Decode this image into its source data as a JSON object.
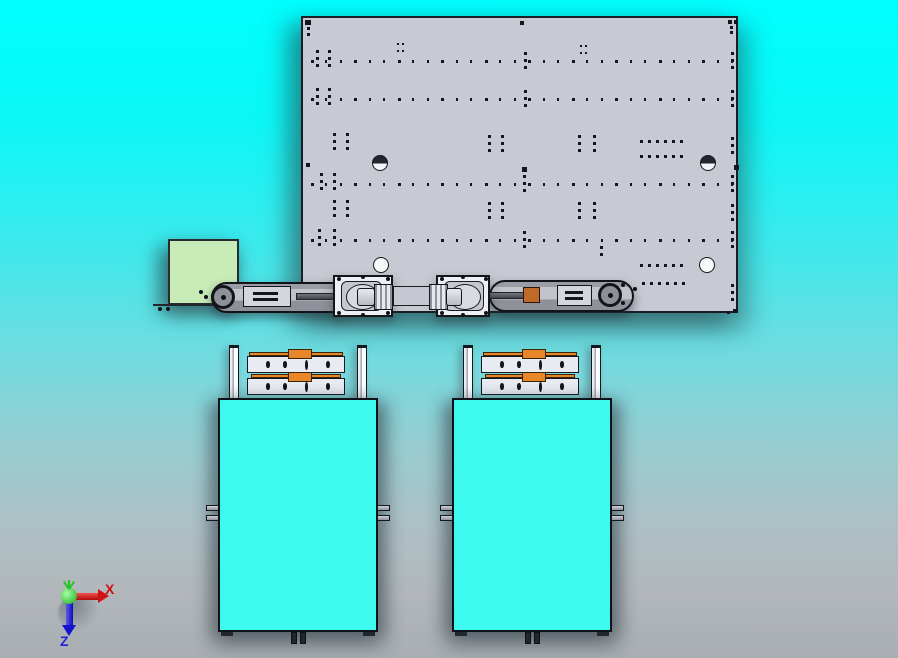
{
  "viewport": {
    "width": 898,
    "height": 658,
    "background_top": "#00ffff",
    "background_bottom": "#a9aeb2"
  },
  "triad": {
    "origin": {
      "x": 70,
      "y": 597
    },
    "x_label": "X",
    "z_label": "Z",
    "x_color": "#cc0f0f",
    "z_color": "#2222d8",
    "y_color": "#27c427"
  },
  "colors": {
    "plate_fill": "#c8c9d2",
    "plate_line": "#1a1d24",
    "green_box": "#c8ecb8",
    "cart_cyan": "#3efaee",
    "orange": "#e8872a",
    "part_white": "#edeff5",
    "arm_gray": "#b0b2ba",
    "rod_dark": "#4e5058"
  },
  "plate": {
    "x": 301,
    "y": 16,
    "w": 437,
    "h": 297,
    "tick_rows": [
      {
        "y": 42,
        "x0": 8,
        "x1": 428,
        "n": 30
      },
      {
        "y": 80,
        "x0": 8,
        "x1": 428,
        "n": 30
      },
      {
        "y": 165,
        "x0": 8,
        "x1": 428,
        "n": 30
      },
      {
        "y": 221,
        "x0": 8,
        "x1": 428,
        "n": 30
      }
    ],
    "pair_columns": [
      {
        "x": 13,
        "y": 32
      },
      {
        "x": 25,
        "y": 32
      },
      {
        "x": 221,
        "y": 34
      },
      {
        "x": 428,
        "y": 34
      },
      {
        "x": 13,
        "y": 70
      },
      {
        "x": 25,
        "y": 70
      },
      {
        "x": 221,
        "y": 72
      },
      {
        "x": 428,
        "y": 72
      },
      {
        "x": 17,
        "y": 155
      },
      {
        "x": 30,
        "y": 155
      },
      {
        "x": 220,
        "y": 157
      },
      {
        "x": 428,
        "y": 157
      },
      {
        "x": 15,
        "y": 211
      },
      {
        "x": 30,
        "y": 211
      },
      {
        "x": 220,
        "y": 213
      },
      {
        "x": 428,
        "y": 213
      },
      {
        "x": 30,
        "y": 115
      },
      {
        "x": 43,
        "y": 115
      },
      {
        "x": 185,
        "y": 117
      },
      {
        "x": 198,
        "y": 117
      },
      {
        "x": 275,
        "y": 117
      },
      {
        "x": 290,
        "y": 117
      },
      {
        "x": 428,
        "y": 119
      },
      {
        "x": 30,
        "y": 182
      },
      {
        "x": 43,
        "y": 182
      },
      {
        "x": 185,
        "y": 184
      },
      {
        "x": 198,
        "y": 184
      },
      {
        "x": 275,
        "y": 184
      },
      {
        "x": 290,
        "y": 184
      },
      {
        "x": 428,
        "y": 186
      },
      {
        "x": 297,
        "y": 228,
        "n": 2
      },
      {
        "x": 428,
        "y": 266
      }
    ],
    "cluster_rows": [
      {
        "x": 337,
        "y": 122,
        "n": 6,
        "gap": 8
      },
      {
        "x": 337,
        "y": 137,
        "n": 6,
        "gap": 8
      },
      {
        "x": 337,
        "y": 246,
        "n": 6,
        "gap": 8
      },
      {
        "x": 339,
        "y": 264,
        "n": 6,
        "gap": 8
      }
    ],
    "dot_grids": [
      {
        "x": 94,
        "y": 25
      },
      {
        "x": 277,
        "y": 27
      }
    ],
    "cap_circles": [
      {
        "x": 76,
        "y": 144,
        "r": 7
      },
      {
        "x": 404,
        "y": 144,
        "r": 7
      }
    ],
    "open_circles": [
      {
        "x": 77,
        "y": 246,
        "r": 7
      },
      {
        "x": 403,
        "y": 246,
        "r": 7
      }
    ],
    "singles": [
      [
        2,
        2,
        6,
        5
      ],
      [
        217,
        3,
        4,
        4
      ],
      [
        425,
        2,
        4,
        4
      ],
      [
        431,
        2,
        4,
        4
      ],
      [
        3,
        145,
        4,
        4
      ],
      [
        431,
        147,
        5,
        5
      ],
      [
        219,
        149,
        5,
        5
      ],
      [
        4,
        9,
        3,
        3
      ],
      [
        4,
        15,
        3,
        3
      ],
      [
        427,
        8,
        3,
        3
      ],
      [
        427,
        13,
        3,
        3
      ],
      [
        430,
        291,
        4,
        4
      ],
      [
        424,
        293,
        3,
        3
      ]
    ]
  },
  "green_box": {
    "x": 168,
    "y": 239,
    "w": 71,
    "h": 66
  },
  "mechanism": {
    "lines": [
      {
        "x": 153,
        "y": 304,
        "w": 100,
        "h": 2
      }
    ],
    "arms": [
      {
        "x": 211,
        "y": 282,
        "w": 140,
        "h": 31
      },
      {
        "x": 489,
        "y": 280,
        "w": 145,
        "h": 32
      }
    ],
    "rods": [
      {
        "x": 296,
        "y": 293,
        "w": 66,
        "h": 7
      },
      {
        "x": 463,
        "y": 292,
        "w": 72,
        "h": 7
      }
    ],
    "blocks": [
      {
        "x": 333,
        "y": 275,
        "w": 60,
        "h": 42
      },
      {
        "x": 436,
        "y": 275,
        "w": 54,
        "h": 42
      }
    ],
    "inners": [
      {
        "x": 341,
        "y": 281,
        "w": 41,
        "h": 30
      },
      {
        "x": 444,
        "y": 281,
        "w": 40,
        "h": 30
      }
    ],
    "slabs": [
      {
        "x": 393,
        "y": 286,
        "w": 38,
        "h": 20
      }
    ],
    "ribs": [
      {
        "x": 374,
        "y": 284,
        "w": 19,
        "h": 26
      },
      {
        "x": 429,
        "y": 284,
        "w": 19,
        "h": 26
      }
    ],
    "nuts": [
      {
        "x": 357,
        "y": 288,
        "w": 18,
        "h": 18
      },
      {
        "x": 446,
        "y": 288,
        "w": 16,
        "h": 18
      }
    ],
    "tips": [
      {
        "cx": 223,
        "cy": 297,
        "r": 12
      },
      {
        "cx": 610,
        "cy": 295,
        "r": 12
      }
    ],
    "mounts": [
      {
        "x": 243,
        "y": 286,
        "w": 48,
        "h": 21
      },
      {
        "x": 557,
        "y": 285,
        "w": 35,
        "h": 21
      }
    ],
    "bushings": [
      {
        "x": 523,
        "y": 287,
        "w": 17,
        "h": 16
      }
    ],
    "screws": [
      [
        337,
        277
      ],
      [
        386,
        277
      ],
      [
        337,
        311
      ],
      [
        386,
        311
      ],
      [
        361,
        275
      ],
      [
        361,
        313
      ],
      [
        440,
        277
      ],
      [
        484,
        277
      ],
      [
        440,
        311
      ],
      [
        484,
        311
      ],
      [
        461,
        275
      ],
      [
        461,
        313
      ],
      [
        199,
        290
      ],
      [
        204,
        295
      ],
      [
        621,
        283
      ],
      [
        621,
        301
      ],
      [
        633,
        287
      ],
      [
        158,
        307
      ],
      [
        166,
        307
      ]
    ]
  },
  "carts": {
    "origins": [
      {
        "x": 218,
        "y": 345
      },
      {
        "x": 452,
        "y": 345
      }
    ],
    "body": {
      "x": 0,
      "y": 53,
      "w": 160,
      "h": 234
    },
    "posts": [
      {
        "x": 11,
        "y": 0,
        "w": 10,
        "h": 56
      },
      {
        "x": 139,
        "y": 0,
        "w": 10,
        "h": 56
      }
    ],
    "strips": [
      {
        "x": 31,
        "y": 7,
        "w": 94,
        "h": 4
      },
      {
        "x": 33,
        "y": 29,
        "w": 90,
        "h": 4
      }
    ],
    "tabs": [
      {
        "x": 70,
        "y": 4,
        "w": 24,
        "h": 10
      },
      {
        "x": 70,
        "y": 27,
        "w": 24,
        "h": 10
      }
    ],
    "bars": [
      {
        "x": 29,
        "y": 11,
        "w": 98,
        "h": 17
      },
      {
        "x": 29,
        "y": 33,
        "w": 98,
        "h": 17
      }
    ],
    "bar_holes_x": [
      48,
      65,
      108
    ],
    "bar_slot_x": 87,
    "bar_hole_y": [
      16,
      38
    ],
    "side_tabs": [
      {
        "x": -12,
        "y": 160,
        "w": 13,
        "h": 6
      },
      {
        "x": -12,
        "y": 170,
        "w": 13,
        "h": 6
      },
      {
        "x": 159,
        "y": 160,
        "w": 13,
        "h": 6
      },
      {
        "x": 159,
        "y": 170,
        "w": 13,
        "h": 6
      }
    ],
    "feet": [
      {
        "x": 73,
        "y": 287,
        "w": 6,
        "h": 12
      },
      {
        "x": 82,
        "y": 287,
        "w": 6,
        "h": 12
      }
    ],
    "nubs": [
      {
        "x": 3,
        "y": 287,
        "w": 12,
        "h": 4
      },
      {
        "x": 145,
        "y": 287,
        "w": 12,
        "h": 4
      }
    ]
  }
}
